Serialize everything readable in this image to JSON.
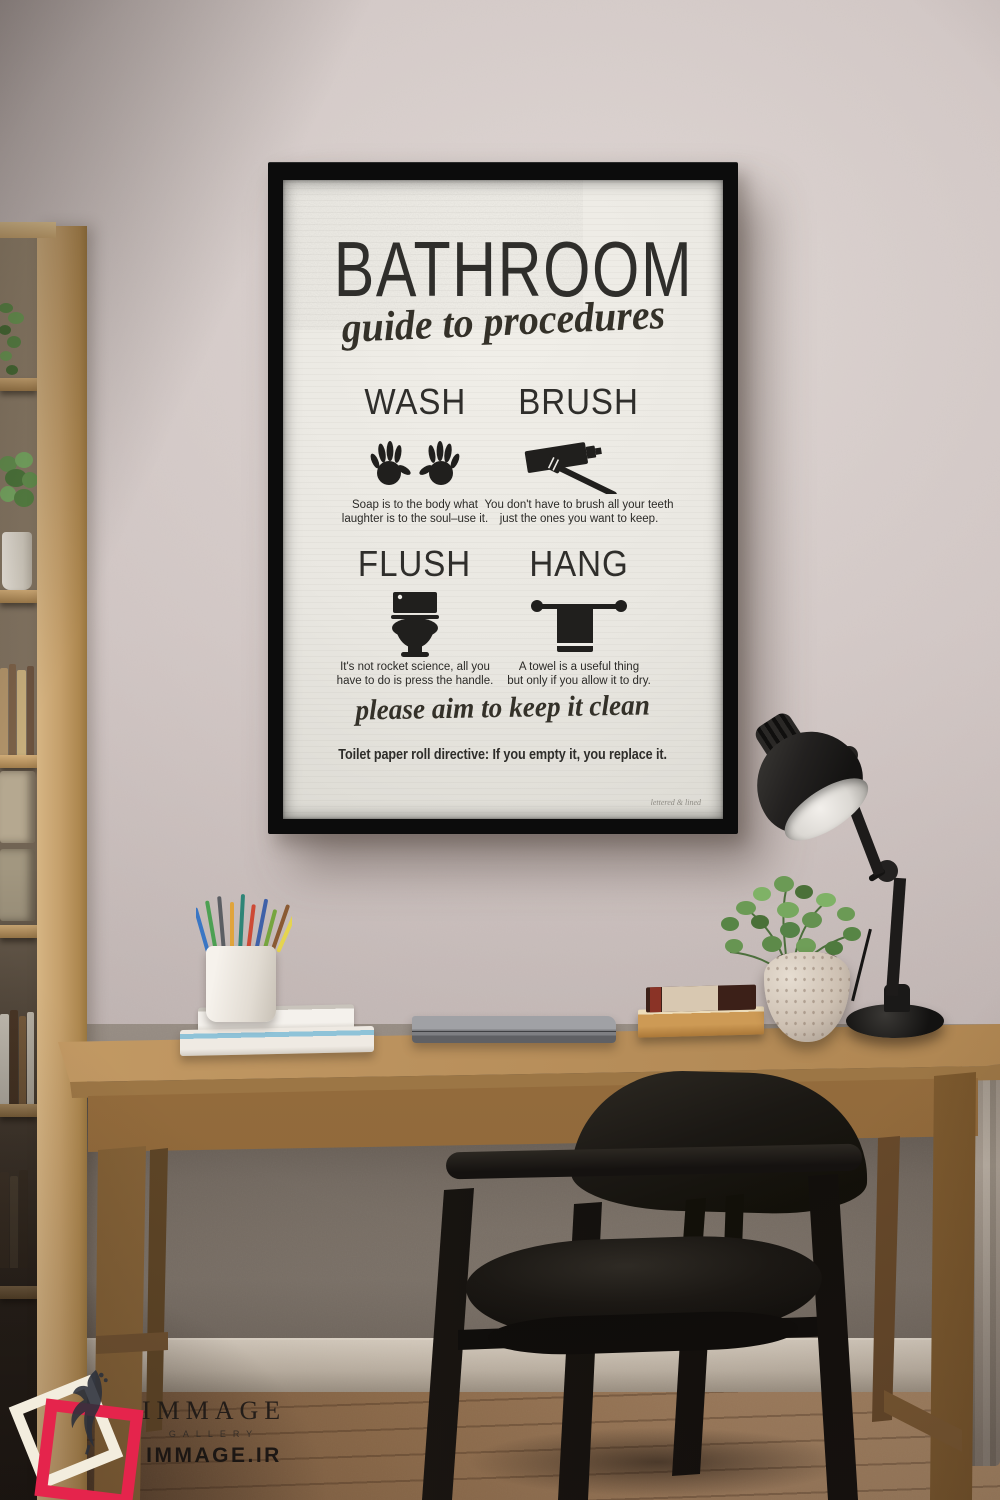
{
  "poster": {
    "title": "BATHROOM",
    "subtitle": "guide to procedures",
    "sections": [
      {
        "heading": "WASH",
        "icon": "handprints-icon",
        "lines": [
          "Soap is to the body what",
          "laughter is to the soul–use it."
        ]
      },
      {
        "heading": "BRUSH",
        "icon": "toothpaste-toothbrush-icon",
        "lines": [
          "You don't have to brush all your teeth",
          "just the ones you want to keep."
        ]
      },
      {
        "heading": "FLUSH",
        "icon": "toilet-icon",
        "lines": [
          "It's not rocket science, all you",
          "have to do is press the handle."
        ]
      },
      {
        "heading": "HANG",
        "icon": "towel-rail-icon",
        "lines": [
          "A towel is a useful thing",
          "but only if you allow it to dry."
        ]
      }
    ],
    "footer_script": "please aim to keep it clean",
    "footer_directive": "Toilet paper roll directive: If you empty it, you replace it.",
    "signature": "lettered & lined"
  },
  "watermark": {
    "brand": "IMMAGE",
    "sub": "GALLERY",
    "domain_text": "IMMAGE.IR",
    "logo_icon": "peacock-icon",
    "square_colors": {
      "outer": "#f3edde",
      "inner": "#e5244c"
    }
  },
  "scene_objects": [
    "wall",
    "framed-poster",
    "bookshelf",
    "desk",
    "desk-lamp",
    "potted-plant",
    "books",
    "pencil-cup",
    "laptop",
    "chair",
    "curtain",
    "wood-floor"
  ],
  "colors": {
    "wall": "#cdc2c0",
    "frame": "#0c0c0c",
    "canvas": "#edebe6",
    "poster_ink": "#2f2e2b",
    "desk_wood": "#bb925e",
    "shelf_wood": "#c5a06c",
    "floor_wood": "#95714e",
    "chair_black": "#1b1814",
    "lamp_black": "#1d1b1a",
    "plant_green": "#6b9a55",
    "watermark_red": "#e5244c",
    "watermark_cream": "#f3edde"
  }
}
